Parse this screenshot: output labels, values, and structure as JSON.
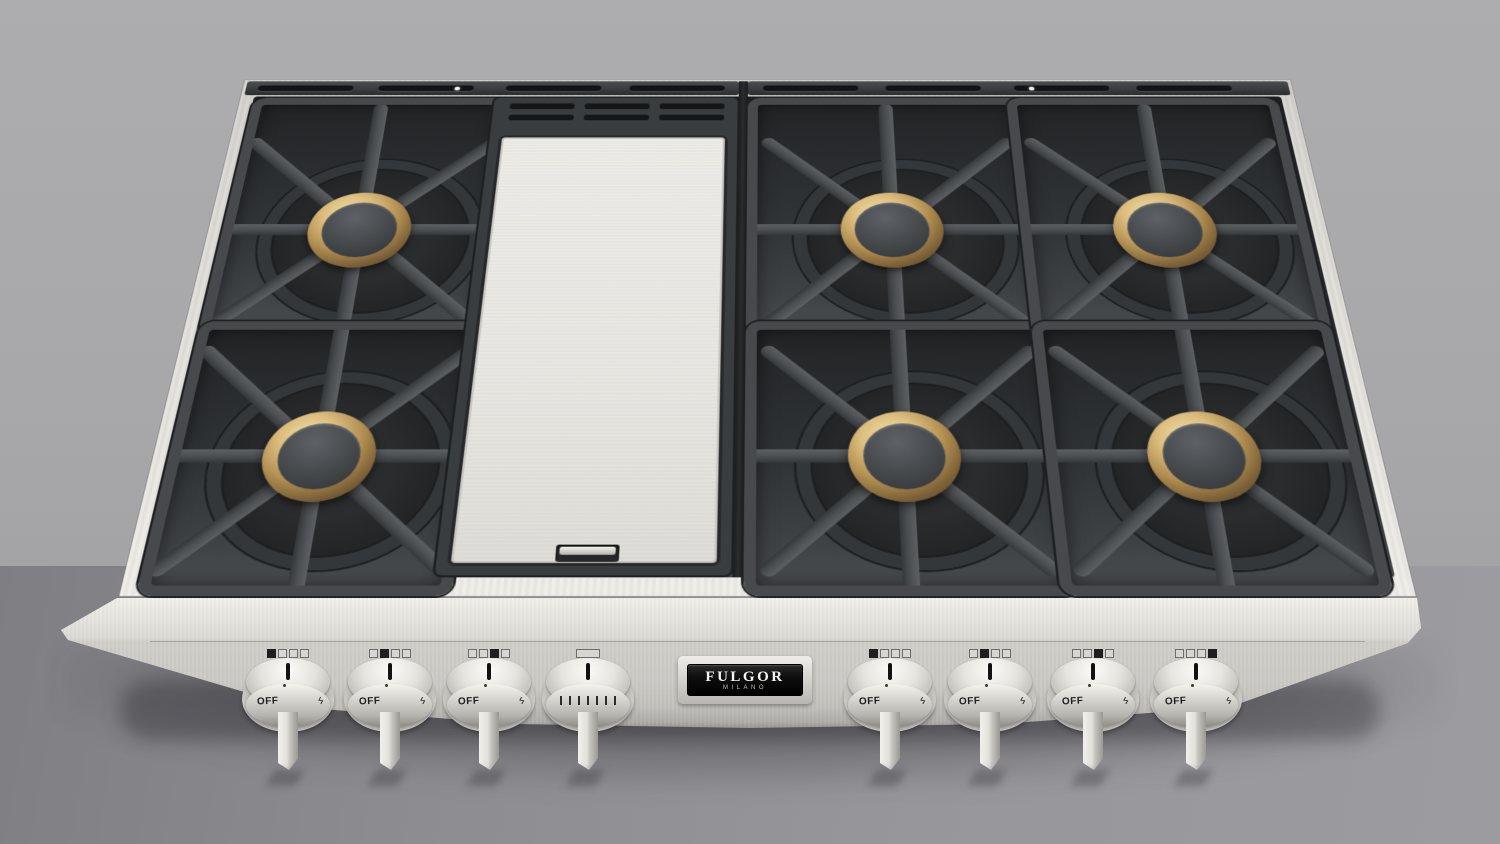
{
  "scene": {
    "description": "3D product render of a stainless steel professional gas rangetop on a gray counter against a gray wall",
    "background": {
      "wall_color": "#a9a9ab",
      "counter_color": "#919195"
    }
  },
  "rangetop": {
    "badge": {
      "brand": "FULGOR",
      "sub_brand": "MILANO"
    },
    "top_surface": {
      "burner_count": 6,
      "has_center_griddle_cover": true,
      "rear_vent_slots_per_side": 4,
      "griddle_back_vent_rows": 2,
      "colors": {
        "stainless": "#e2e0db",
        "grate": "#4b4e51",
        "burner_well": "#232527",
        "brass_burner_ring": "#c8a96a",
        "burner_cap": "#44474a",
        "griddle_cover": "#eae9e4",
        "rear_trim": "#3a3d40"
      }
    },
    "controls": {
      "flame_glyph": "ϟ",
      "knob_count": 8,
      "knobs": [
        {
          "id": "left-1",
          "label": "OFF",
          "type": "burner",
          "indicator": 0
        },
        {
          "id": "left-2",
          "label": "OFF",
          "type": "burner",
          "indicator": 1
        },
        {
          "id": "left-3",
          "label": "OFF",
          "type": "burner",
          "indicator": 2
        },
        {
          "id": "left-4",
          "label": "",
          "type": "griddle",
          "indicator": -1
        },
        {
          "id": "right-1",
          "label": "OFF",
          "type": "burner",
          "indicator": 0
        },
        {
          "id": "right-2",
          "label": "OFF",
          "type": "burner",
          "indicator": 1
        },
        {
          "id": "right-3",
          "label": "OFF",
          "type": "burner",
          "indicator": 2
        },
        {
          "id": "right-4",
          "label": "OFF",
          "type": "burner",
          "indicator": 3
        }
      ]
    }
  }
}
